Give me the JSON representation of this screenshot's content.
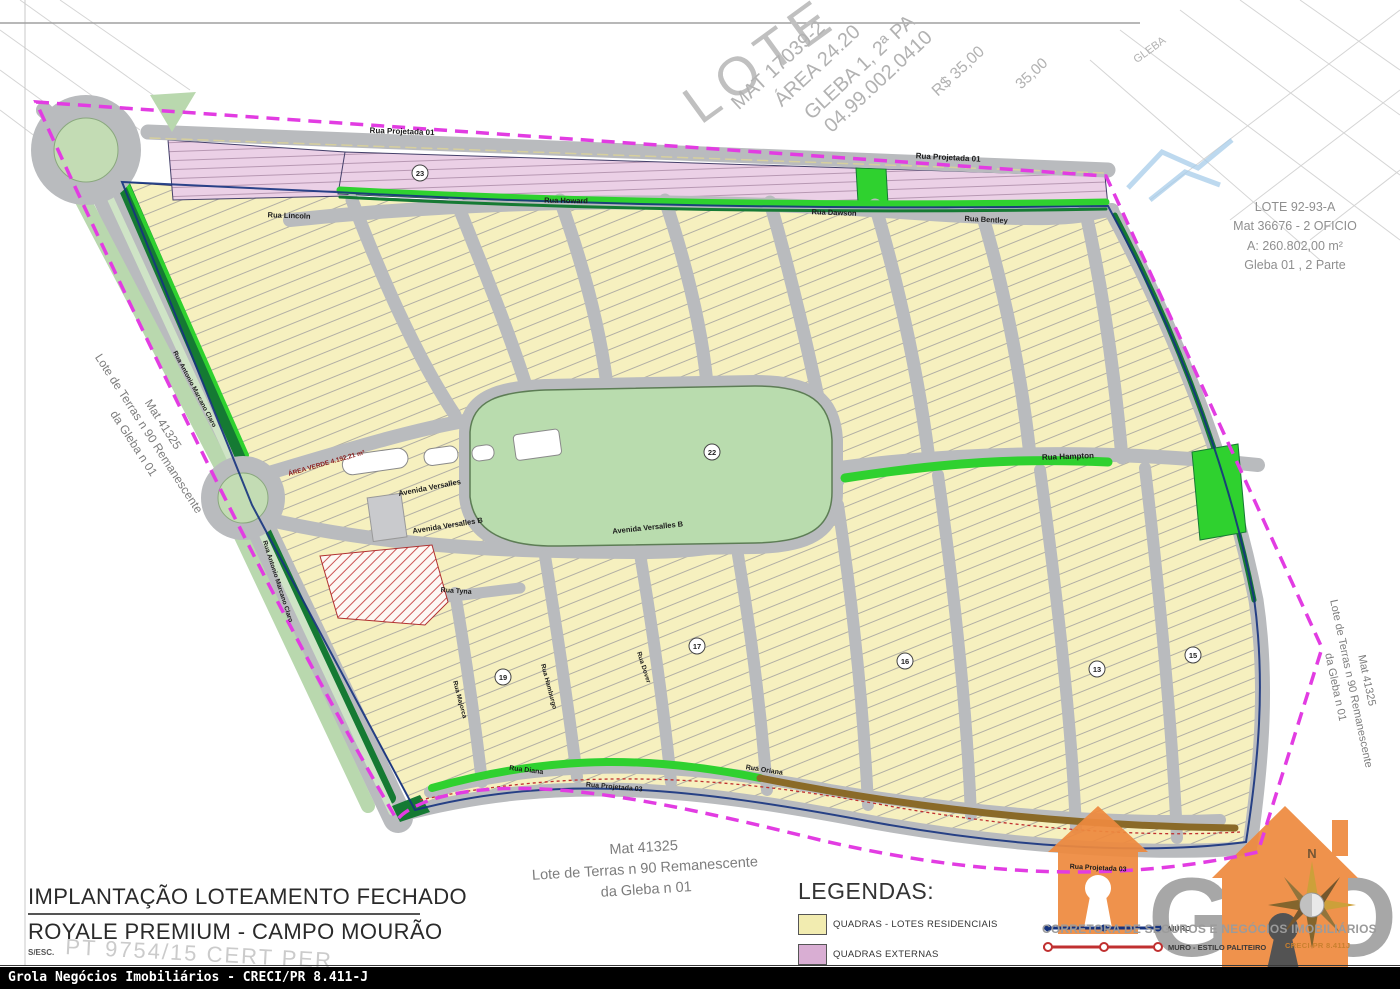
{
  "map_colors": {
    "boundary_magenta": "#e23ce2",
    "road_gray": "#b9bbbe",
    "residential_yellow": "#f6f0bf",
    "external_pink": "#ebd0e6",
    "park_green": "#b9dcae",
    "bright_green": "#2fd12f",
    "dark_green": "#157a33",
    "muro_blue": "#16337e",
    "muro_red": "#c03030",
    "brand_orange": "#ee8a3f"
  },
  "title_block": {
    "line1": "IMPLANTAÇÃO LOTEAMENTO FECHADO",
    "line2": "ROYALE PREMIUM - CAMPO MOURÃO",
    "scale_note": "S/ESC.",
    "watermark": "PT 9754/15 CERT PER"
  },
  "footer": {
    "bar_text": "Grola Negócios Imobiliários - CRECI/PR 8.411-J"
  },
  "legend": {
    "heading": "LEGENDAS:",
    "items": [
      {
        "label": "QUADRAS - LOTES RESIDENCIAIS",
        "color": "#f2ecb0"
      },
      {
        "label": "QUADRAS EXTERNAS",
        "color": "#d9aed3"
      }
    ],
    "line_items": [
      {
        "label": "MURO",
        "color": "#16337e"
      },
      {
        "label": "MURO - ESTILO PALITEIRO",
        "color": "#c03030"
      }
    ]
  },
  "brand": {
    "logo_text": "GROLA",
    "tagline": "CORRETORA DE SEGUROS E NEGÓCIOS IMOBILIÁRIOS",
    "creci": "CRECI-PR 8.411J",
    "compass_n": "N"
  },
  "annotations": {
    "mat41325": {
      "lines": [
        "Mat 41325",
        "Lote de Terras n 90 Remanescente",
        "da Gleba n 01"
      ]
    },
    "lote9293": {
      "lines": [
        "LOTE 92-93-A",
        "Mat 36676 - 2 OFICIO",
        "A: 260.802,00 m²",
        "Gleba 01 , 2 Parte"
      ]
    },
    "area_verde": "ÁREA VERDE 4.192,21 m²",
    "park_number": "22"
  },
  "watermarks": {
    "top_diagonal": [
      {
        "text": "LOTE",
        "x": 690,
        "y": 80,
        "rot": -36,
        "size": 54
      },
      {
        "text": "MAT 17039-2",
        "x": 735,
        "y": 95,
        "rot": -43,
        "size": 20
      },
      {
        "text": "ÁREA 24.20",
        "x": 778,
        "y": 92,
        "rot": -43,
        "size": 20
      },
      {
        "text": "GLEBA 1, 2ª PA",
        "x": 808,
        "y": 105,
        "rot": -43,
        "size": 20
      },
      {
        "text": "04.99.002.0410",
        "x": 828,
        "y": 118,
        "rot": -43,
        "size": 20
      },
      {
        "text": "R$ 35,00",
        "x": 935,
        "y": 85,
        "rot": -43,
        "size": 16
      },
      {
        "text": "35,00",
        "x": 1018,
        "y": 78,
        "rot": -43,
        "size": 15
      },
      {
        "text": "GLEBA",
        "x": 1135,
        "y": 55,
        "rot": -36,
        "size": 11
      }
    ]
  },
  "map": {
    "street_labels": [
      {
        "name": "Rua Projetada 01",
        "x": 402,
        "y": 134,
        "rot": 2,
        "size": 8
      },
      {
        "name": "Rua Projetada 01",
        "x": 948,
        "y": 160,
        "rot": 3,
        "size": 8
      },
      {
        "name": "Rua Lincoln",
        "x": 289,
        "y": 218,
        "rot": 2,
        "size": 7.5
      },
      {
        "name": "Rua Howard",
        "x": 566,
        "y": 203,
        "rot": 1,
        "size": 7.5
      },
      {
        "name": "Rua Dawson",
        "x": 834,
        "y": 215,
        "rot": 2,
        "size": 7.5
      },
      {
        "name": "Rua Bentley",
        "x": 986,
        "y": 222,
        "rot": 3,
        "size": 7.5
      },
      {
        "name": "Rua Hampton",
        "x": 1068,
        "y": 459,
        "rot": -2,
        "size": 8
      },
      {
        "name": "Avenida Versalles",
        "x": 430,
        "y": 490,
        "rot": -11,
        "size": 7.5
      },
      {
        "name": "Avenida Versalles B",
        "x": 448,
        "y": 528,
        "rot": -9,
        "size": 7.5
      },
      {
        "name": "Avenida Versalles B",
        "x": 648,
        "y": 530,
        "rot": -6,
        "size": 7.5
      },
      {
        "name": "Rua Antonio Marcano Claro",
        "x": 193,
        "y": 390,
        "rot": 62,
        "size": 6.5
      },
      {
        "name": "Rua Antonio Marcano Claro",
        "x": 276,
        "y": 582,
        "rot": 72,
        "size": 6.5
      },
      {
        "name": "Rua Tyna",
        "x": 456,
        "y": 593,
        "rot": 4,
        "size": 7
      },
      {
        "name": "Rua Majorca",
        "x": 458,
        "y": 700,
        "rot": 75,
        "size": 6.5
      },
      {
        "name": "Rua Hamburgo",
        "x": 547,
        "y": 687,
        "rot": 75,
        "size": 6.5
      },
      {
        "name": "Rua Dover",
        "x": 642,
        "y": 668,
        "rot": 72,
        "size": 6.5
      },
      {
        "name": "Rua Diana",
        "x": 526,
        "y": 772,
        "rot": 7,
        "size": 7
      },
      {
        "name": "Rua Oriana",
        "x": 764,
        "y": 772,
        "rot": 9,
        "size": 7
      },
      {
        "name": "Rua Projetada 03",
        "x": 614,
        "y": 789,
        "rot": 5,
        "size": 7
      },
      {
        "name": "Rua Projetada 03",
        "x": 1098,
        "y": 870,
        "rot": 3,
        "size": 7
      }
    ],
    "block_numbers": [
      {
        "n": "23",
        "x": 420,
        "y": 173
      },
      {
        "n": "22",
        "x": 712,
        "y": 452
      },
      {
        "n": "19",
        "x": 503,
        "y": 677
      },
      {
        "n": "17",
        "x": 697,
        "y": 646
      },
      {
        "n": "16",
        "x": 905,
        "y": 661
      },
      {
        "n": "15",
        "x": 1193,
        "y": 655
      },
      {
        "n": "13",
        "x": 1097,
        "y": 669
      }
    ]
  }
}
